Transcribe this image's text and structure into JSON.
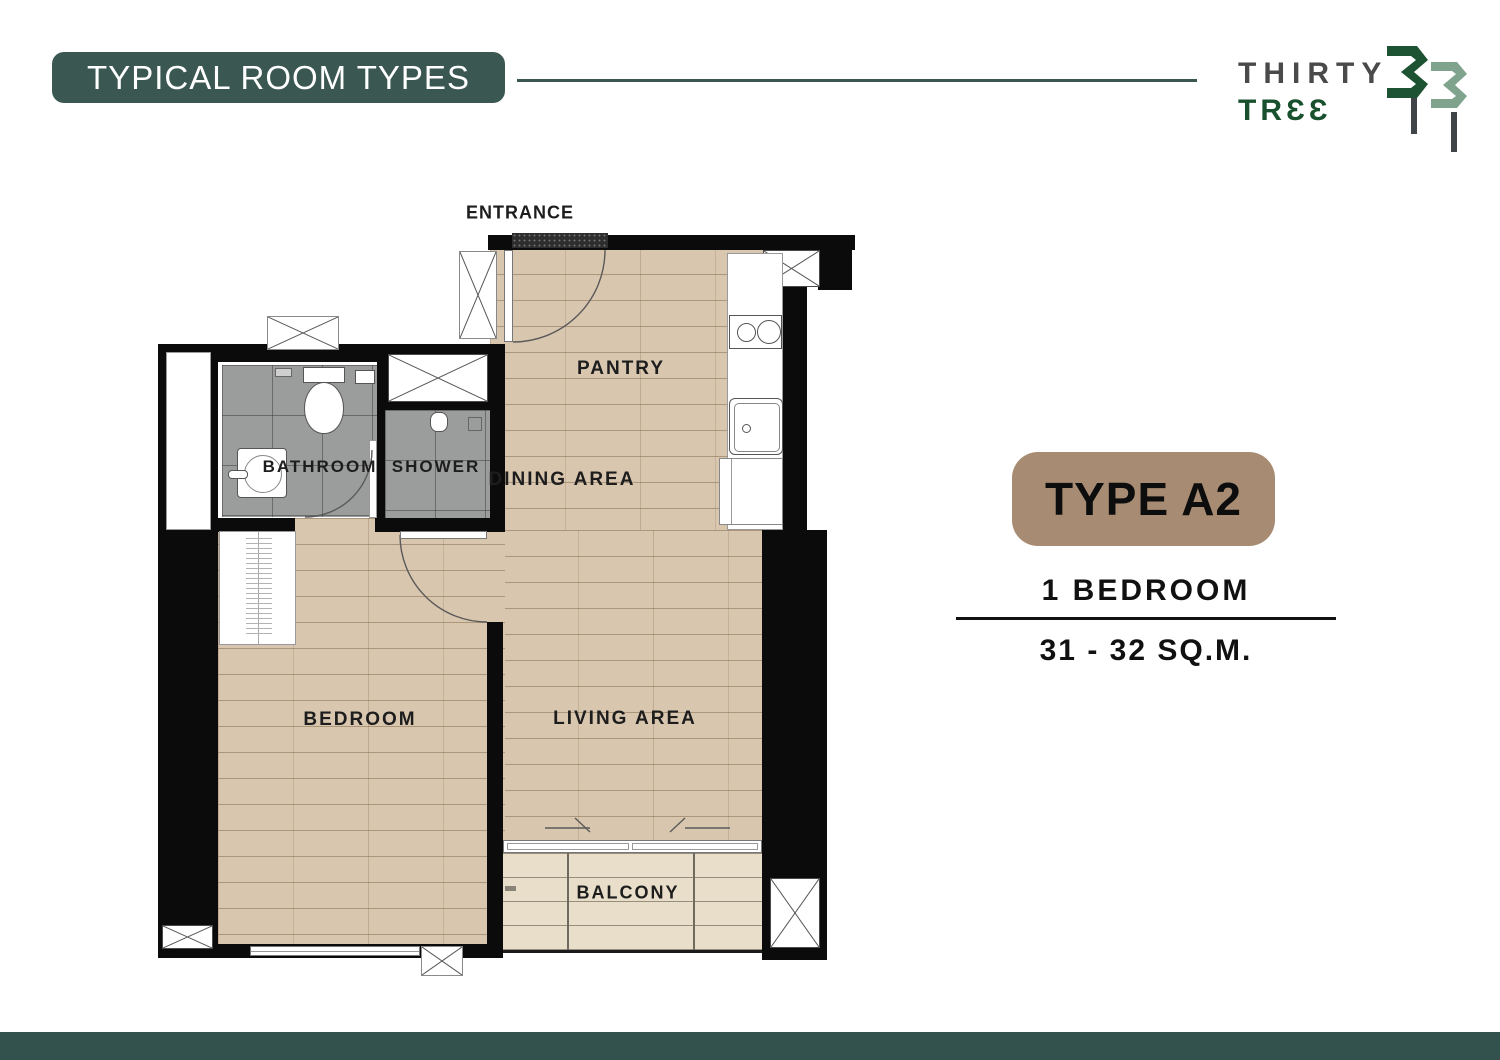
{
  "header": {
    "title": "TYPICAL ROOM TYPES"
  },
  "logo": {
    "word_top": "THIRTY",
    "word_bottom": "TRƐƐ",
    "numeral": "33"
  },
  "floor_plan": {
    "labels": {
      "entrance": "ENTRANCE",
      "pantry": "PANTRY",
      "dining_area": "DINING AREA",
      "bathroom": "BATHROOM",
      "shower": "SHOWER",
      "bedroom": "BEDROOM",
      "living_area": "LIVING AREA",
      "balcony": "BALCONY"
    }
  },
  "info": {
    "type": "TYPE A2",
    "bedrooms": "1 BEDROOM",
    "area": "31 - 32 SQ.M."
  },
  "colors": {
    "teal": "#3A5751",
    "footer_teal": "#33514D",
    "badge_tan": "#A78B73",
    "wood": "#D9C6AF",
    "balcony_deck": "#E9DECA",
    "tile_gray": "#9B9D9C",
    "wall_black": "#0B0B0B",
    "logo_green": "#19512F",
    "logo_sage": "#7FA38D",
    "logo_gray": "#4A4A4A"
  }
}
